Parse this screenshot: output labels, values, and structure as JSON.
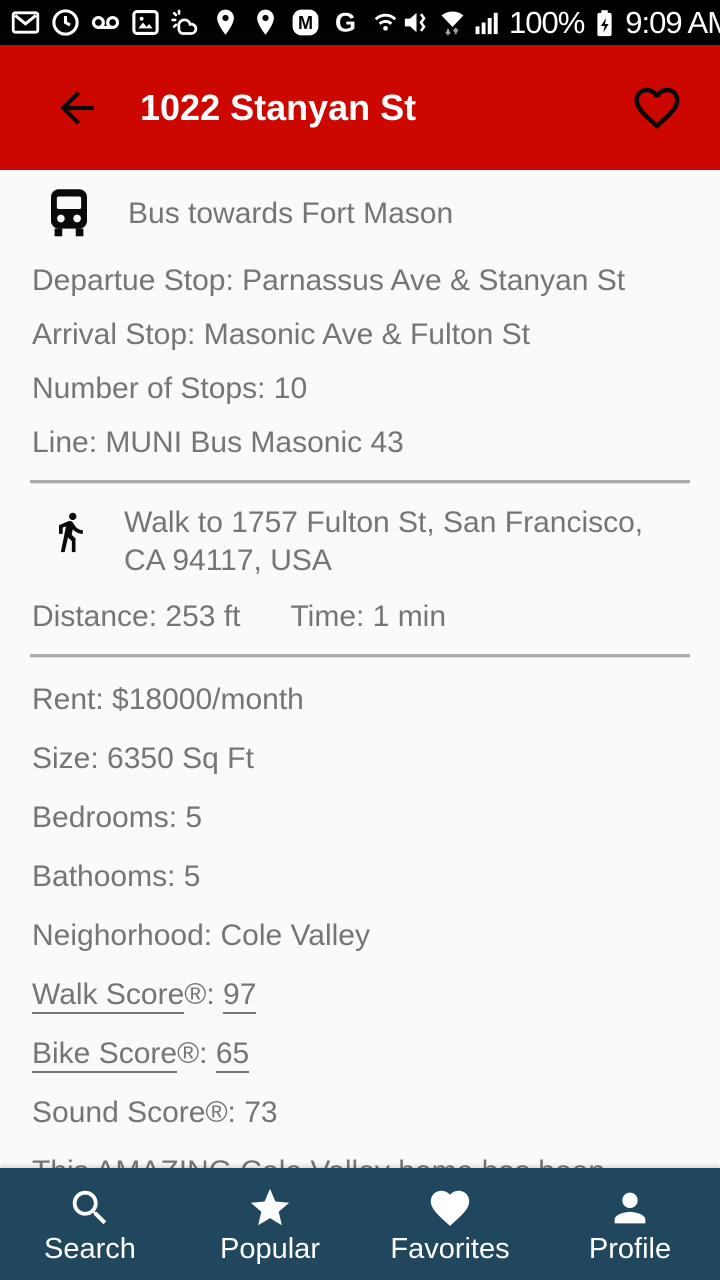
{
  "status_bar": {
    "time": "9:09 AM",
    "battery_percent": "100%",
    "left_icons": [
      "gmail",
      "data-usage-clock",
      "voicemail",
      "photos",
      "weather",
      "maps-pin",
      "maps-pin",
      "m-badge",
      "google-g",
      "network-monitor"
    ],
    "right_icons": [
      "volume-muted-vibrate",
      "wifi-updown",
      "signal-strength",
      "battery-charging"
    ]
  },
  "app_bar": {
    "title": "1022 Stanyan St"
  },
  "route": {
    "bus": {
      "header": "Bus towards Fort Mason",
      "departure": "Departue Stop: Parnassus Ave & Stanyan St",
      "arrival": "Arrival Stop: Masonic Ave & Fulton St",
      "stops": "Number of Stops: 10",
      "line": "Line: MUNI Bus Masonic 43"
    },
    "walk": {
      "header": "Walk to 1757 Fulton St, San Francisco, CA 94117, USA",
      "distance": "Distance: 253 ft",
      "time": "Time: 1 min"
    }
  },
  "listing": {
    "rent": "Rent: $18000/month",
    "size": "Size: 6350 Sq Ft",
    "bedrooms": "Bedrooms: 5",
    "bathrooms": "Bathooms: 5",
    "neighborhood": "Neighorhood: Cole Valley",
    "walk_score": {
      "link": "Walk Score",
      "suffix": "®: ",
      "value": "97"
    },
    "bike_score": {
      "link": "Bike Score",
      "suffix": "®: ",
      "value": "65"
    },
    "sound_score": "Sound Score®: 73",
    "description_preview": "This AMAZING Cole Valley home has been"
  },
  "bottom_nav": {
    "items": [
      {
        "label": "Search",
        "icon": "search-icon"
      },
      {
        "label": "Popular",
        "icon": "star-icon"
      },
      {
        "label": "Favorites",
        "icon": "heart-icon"
      },
      {
        "label": "Profile",
        "icon": "person-icon"
      }
    ]
  },
  "colors": {
    "app_bar_red": "#CC0700",
    "bottom_nav_blue": "#21475F",
    "body_text_gray": "#757575",
    "background": "#FAFAFA",
    "status_bar_black": "#000000"
  }
}
